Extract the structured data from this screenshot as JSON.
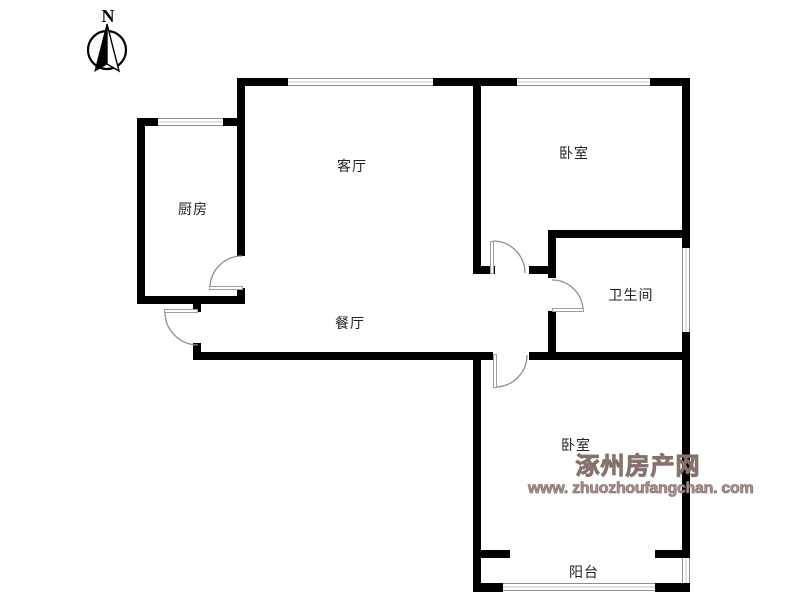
{
  "compass": {
    "label": "N"
  },
  "rooms": {
    "kitchen": "厨房",
    "living_room": "客厅",
    "bedroom_top": "卧室",
    "bathroom": "卫生间",
    "dining_room": "餐厅",
    "bedroom_bottom": "卧室",
    "balcony": "阳台"
  },
  "watermark": {
    "site_name": "涿州房产网",
    "site_url": "www. zhuozhoufangchan. com"
  },
  "colors": {
    "wall": "#000000",
    "window_line": "#8f8f8f",
    "door_leaf": "#9f9f9f",
    "door_arc": "#8f8f8f",
    "watermark_text": "#a5928c",
    "label_text": "#222222"
  }
}
